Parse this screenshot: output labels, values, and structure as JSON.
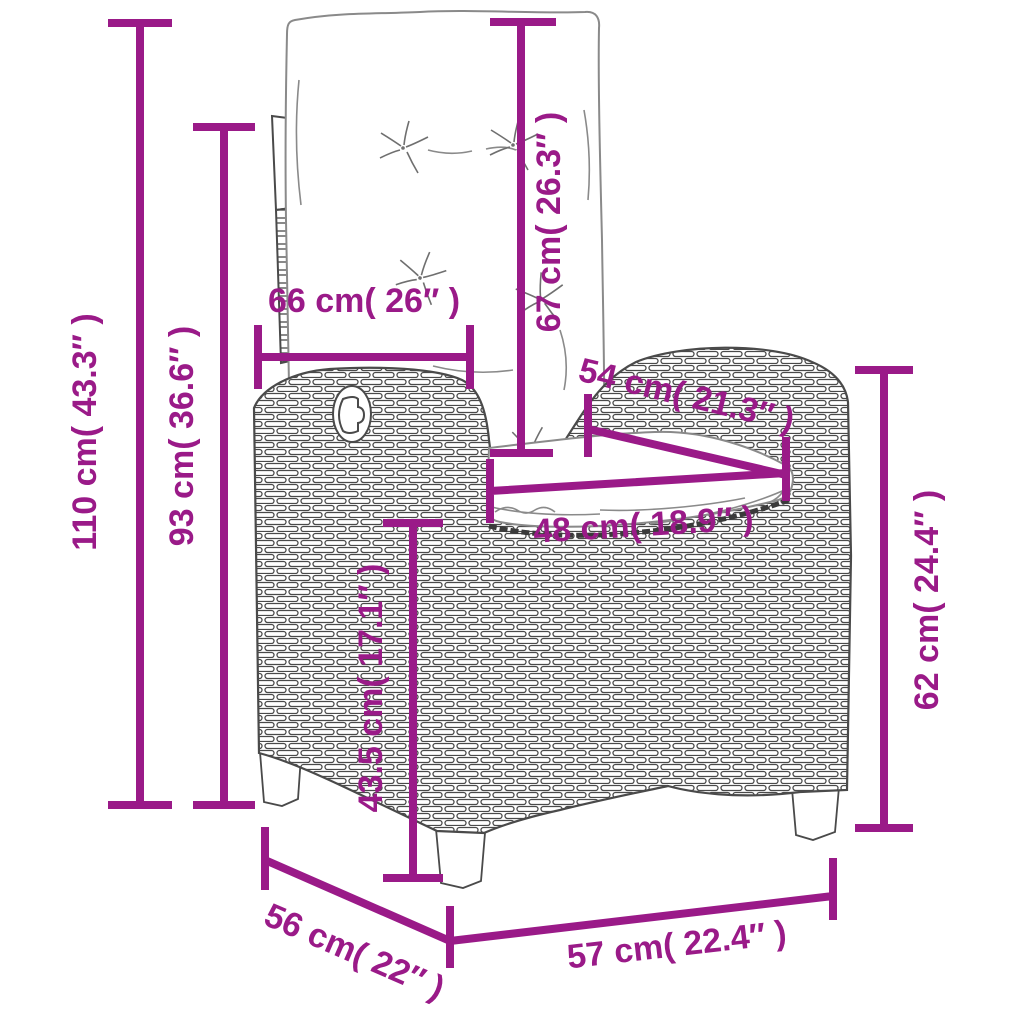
{
  "figure": {
    "kind": "product-dimension-diagram",
    "subject": "reclining-rattan-garden-chair-with-cushions",
    "background_color": "#ffffff",
    "accent_color": "#9a1a88",
    "outline_color": "#4a4a4a",
    "cushion_line_color": "#8a8a8a"
  },
  "dimensions": {
    "overall_height": {
      "label": "110 cm( 43.3″ )"
    },
    "back_height": {
      "label": "93 cm( 36.6″ )"
    },
    "back_width": {
      "label": "66 cm( 26″ )"
    },
    "backrest_length": {
      "label": "67 cm( 26.3″ )"
    },
    "seat_depth": {
      "label": "54 cm( 21.3″ )"
    },
    "seat_width": {
      "label": "48 cm( 18.9″ )"
    },
    "seat_height": {
      "label": "43.5 cm( 17.1″ )"
    },
    "armrest_height": {
      "label": "62 cm( 24.4″ )"
    },
    "base_depth": {
      "label": "56 cm( 22″ )"
    },
    "base_width": {
      "label": "57 cm( 22.4″ )"
    }
  }
}
